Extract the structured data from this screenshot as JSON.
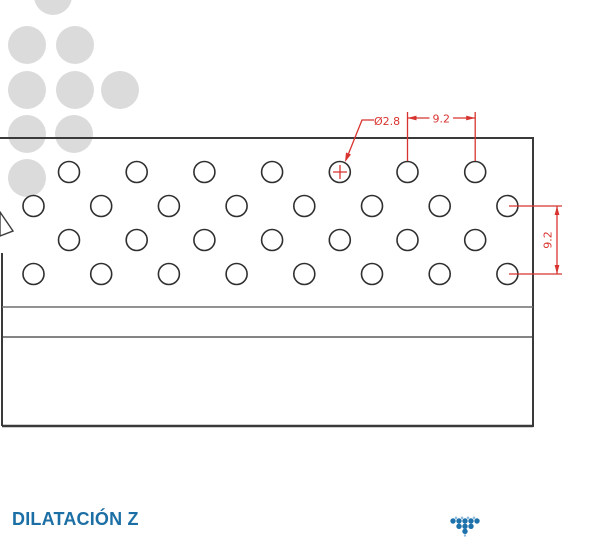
{
  "page": {
    "background": "#ffffff"
  },
  "footer": {
    "title": "DILATACIÓN Z",
    "title_color": "#1c6fa5"
  },
  "drawing": {
    "line_color": "#3a3a3a",
    "annotation_color": "#d8342f",
    "dim_hole_diameter": "Ø2.8",
    "dim_horizontal_pitch": "9.2",
    "dim_vertical_pitch": "9.2",
    "hole_pattern": {
      "radius": 10.5,
      "pitch_px": 67.7,
      "rows": [
        {
          "y": 172,
          "start": 69,
          "count": 7
        },
        {
          "y": 206,
          "start": 33.5,
          "count": 8
        },
        {
          "y": 240,
          "start": 69,
          "count": 7
        },
        {
          "y": 274,
          "start": 33.5,
          "count": 8
        }
      ]
    }
  },
  "decor": {
    "color": "#dbdbdb",
    "radius": 19,
    "dots": [
      [
        53,
        -4
      ],
      [
        27,
        45
      ],
      [
        75,
        45
      ],
      [
        27,
        90
      ],
      [
        75,
        90
      ],
      [
        120,
        90
      ],
      [
        27,
        134
      ],
      [
        74,
        134
      ],
      [
        27,
        178
      ]
    ]
  },
  "logo": {
    "primary_color": "#1e72ab",
    "accent_color": "#8cbbdc"
  }
}
